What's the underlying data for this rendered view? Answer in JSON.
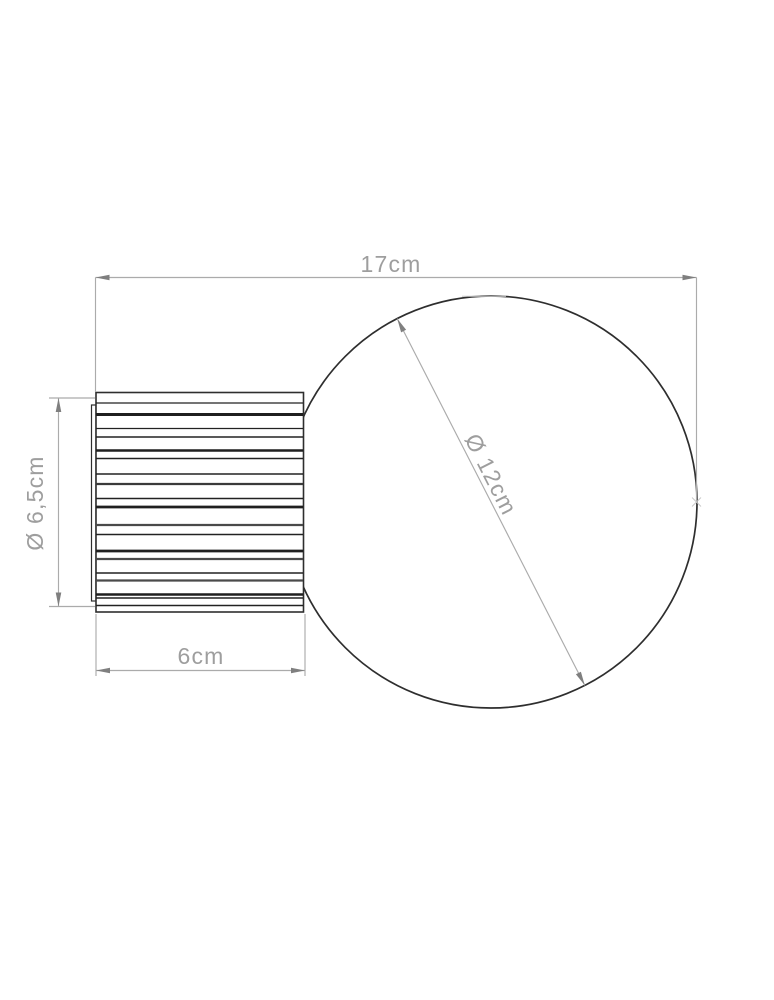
{
  "colors": {
    "background": "#ffffff",
    "drawing-line": "#2e2e2e",
    "dimension-line": "#ababab",
    "arrow": "#7f7f7f",
    "label-text": "#9e9e9e",
    "faint-mark": "#c9c9c9"
  },
  "dimensions": {
    "overall_width": "17cm",
    "base_diameter": "Ø 6,5cm",
    "base_depth": "6cm",
    "sphere_diameter": "Ø 12cm"
  },
  "diagram": {
    "ribs": {
      "x1": 96,
      "x2": 303,
      "lines": [
        {
          "y": 403,
          "w": 1.2,
          "c": "#222222"
        },
        {
          "y": 414.5,
          "w": 3.0,
          "c": "#1f1f1f"
        },
        {
          "y": 428.5,
          "w": 1.2,
          "c": "#222222"
        },
        {
          "y": 437,
          "w": 1.4,
          "c": "#222222"
        },
        {
          "y": 450.5,
          "w": 2.6,
          "c": "#1f1f1f"
        },
        {
          "y": 458.5,
          "w": 1.4,
          "c": "#222222"
        },
        {
          "y": 474,
          "w": 1.4,
          "c": "#222222"
        },
        {
          "y": 484,
          "w": 2.2,
          "c": "#3a3a3a"
        },
        {
          "y": 498.5,
          "w": 1.4,
          "c": "#222222"
        },
        {
          "y": 507,
          "w": 2.8,
          "c": "#1f1f1f"
        },
        {
          "y": 525,
          "w": 2.2,
          "c": "#4a4a4a"
        },
        {
          "y": 534.5,
          "w": 1.4,
          "c": "#222222"
        },
        {
          "y": 551,
          "w": 2.8,
          "c": "#1f1f1f"
        },
        {
          "y": 559,
          "w": 2.2,
          "c": "#4a4a4a"
        },
        {
          "y": 573,
          "w": 1.4,
          "c": "#222222"
        },
        {
          "y": 580.5,
          "w": 2.2,
          "c": "#4a4a4a"
        },
        {
          "y": 594.5,
          "w": 2.4,
          "c": "#1f1f1f"
        },
        {
          "y": 598,
          "w": 1.4,
          "c": "#222222"
        },
        {
          "y": 605.5,
          "w": 1.4,
          "c": "#222222"
        }
      ]
    }
  }
}
